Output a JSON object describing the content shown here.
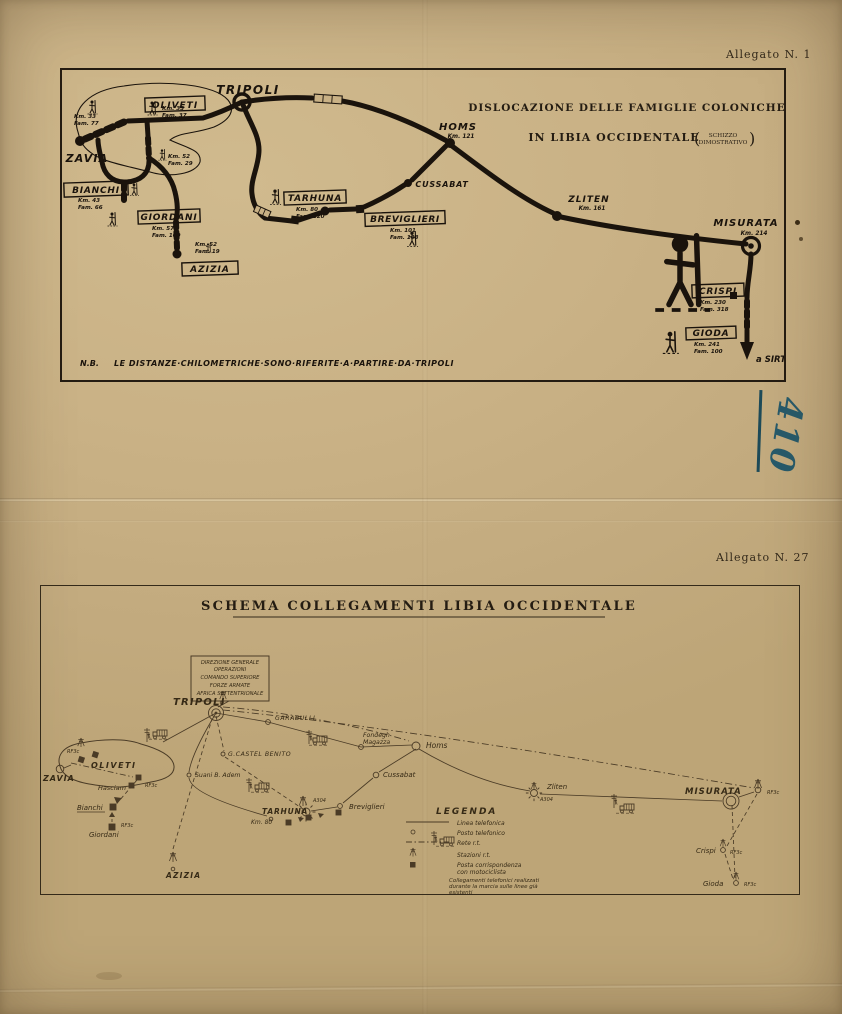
{
  "page": {
    "allegato_top": "Allegato N. 1",
    "allegato_bottom": "Allegato N. 27",
    "handwritten_number": "410",
    "paper_color": "#c9b185",
    "ink_color": "#1a130c",
    "handwriting_color": "#275a6a"
  },
  "map1": {
    "title_line1": "DISLOCAZIONE DELLE FAMIGLIE COLONICHE",
    "title_line2": "IN LIBIA OCCIDENTALE",
    "paren_open": "(",
    "paren_close": ")",
    "title_paren_line1": "SCHIZZO",
    "title_paren_line2": "DIMOSTRATIVO",
    "note_label": "N.B.",
    "note_text": "LE DISTANZE·CHILOMETRICHE·SONO·RIFERITE·A·PARTIRE·DA·TRIPOLI",
    "places": {
      "tripoli": "TRIPOLI",
      "homs": "HOMS",
      "homs_km": "Km. 121",
      "cussabat": "CUSSABAT",
      "zliten": "ZLITEN",
      "zliten_km": "Km. 161",
      "misurata": "MISURATA",
      "misurata_km": "Km. 214",
      "zavia": "ZAVIA",
      "sirte": "a SIRTE"
    },
    "colonies": {
      "oliveti": {
        "name": "OLIVETI"
      },
      "bianchi": {
        "name": "BIANCHI",
        "km": "Km. 43",
        "fam": "Fam. 66"
      },
      "giordani": {
        "name": "GIORDANI",
        "km": "Km. 57",
        "fam": "Fam. 100"
      },
      "tarhuna": {
        "name": "TARHUNA",
        "km": "Km. 80",
        "fam": "Fam. 120"
      },
      "breviglieri": {
        "name": "BREVIGLIERI",
        "km": "Km. 101",
        "fam": "Fam. 103"
      },
      "crispi": {
        "name": "CRISPI",
        "km": "Km. 230",
        "fam": "Fam. 318"
      },
      "gioda": {
        "name": "GIODA",
        "km": "Km. 241",
        "fam": "Fam. 100"
      },
      "azizia": {
        "name": "AZIZIA",
        "km": "Km. 52",
        "fam": "Fam. 19"
      }
    },
    "annotations": {
      "oliveti_left": {
        "km": "Km. 33",
        "fam": "Fam. 77"
      },
      "oliveti_right": {
        "km": "Km. 35",
        "fam": "Fam. 37"
      },
      "oliveti_south": {
        "km": "Km. 52",
        "fam": "Fam. 29"
      }
    }
  },
  "map2": {
    "title": "SCHEMA COLLEGAMENTI LIBIA OCCIDENTALE",
    "hq_box": {
      "line1": "DIREZIONE GENERALE",
      "line2": "OPERAZIONI",
      "line3": "COMANDO SUPERIORE",
      "line4": "FORZE ARMATE",
      "line5": "AFRICA SETTENTRIONALE"
    },
    "places": {
      "tripoli": "TRIPOLI",
      "garabulli": "GARABULLI",
      "fondegh_line1": "Fondegh",
      "fondegh_line2": "Magazza",
      "homs": "Homs",
      "castel_benito": "G.CASTEL BENITO",
      "suani": "Suani B. Adem",
      "cussabat": "Cussabat",
      "tarhuna": "TARHUNA",
      "tarhuna_km": "Km. 80",
      "breviglieri": "Breviglieri",
      "zliten": "Zliten",
      "misurata": "MISURATA",
      "crispi": "Crispi",
      "gioda": "Gioda",
      "zavia": "ZAVIA",
      "oliveti": "OLIVETI",
      "hasciam": "Hasciam",
      "bianchi": "Bianchi",
      "giordani": "Giordani",
      "azizia": "AZIZIA"
    },
    "stations": {
      "rf3c_oliveti": "RF3c",
      "rf3c_hasciam": "RF3c",
      "rf3c_giordani": "RF3c",
      "rf3c_misurata": "RF3c",
      "rf3c_crispi": "RF3c",
      "rf3c_gioda": "RF3c",
      "a304_tarhuna": "A304",
      "a304_zliten": "A304"
    },
    "legend": {
      "title": "LEGENDA",
      "item1": "Linea telefonica",
      "item2": "Posto telefonico",
      "item3": "Rete r.t.",
      "item4": "Stazioni r.t.",
      "item5_line1": "Posta corrispondenza",
      "item5_line2": "con motociclista",
      "item6_line1": "Collegamenti telefonici realizzati",
      "item6_line2": "durante la marcia sulle linee già",
      "item6_line3": "esistenti"
    }
  }
}
